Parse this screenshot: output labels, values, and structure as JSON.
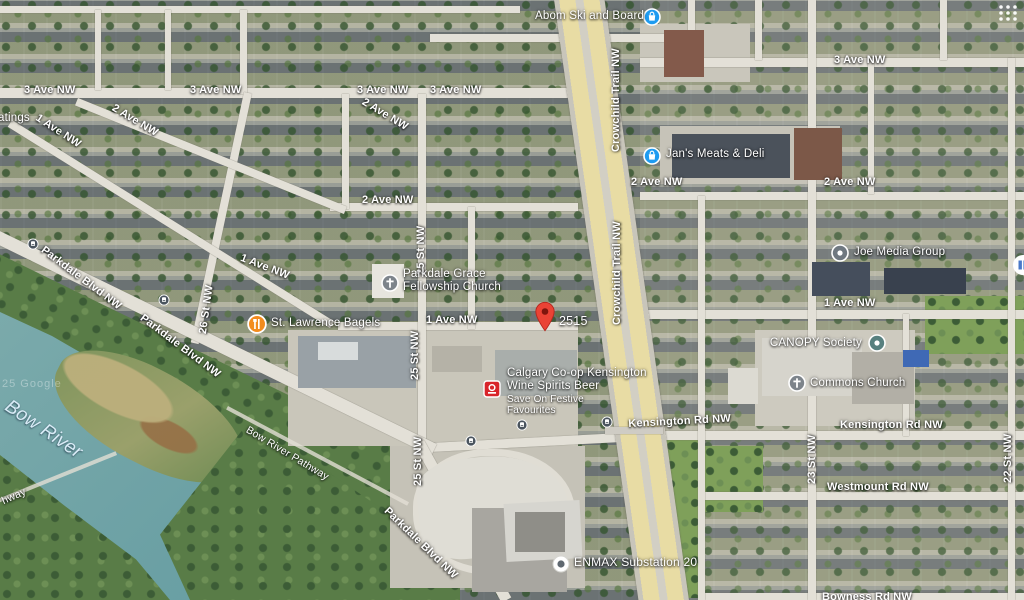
{
  "map": {
    "type": "satellite",
    "watermark": "25 Google",
    "water_name": "Bow River",
    "pathway_label": "Bow River Pathway",
    "pathway_partial": "hway",
    "partial_poi_label": "atings"
  },
  "streets": {
    "ave3": "3 Ave NW",
    "ave2": "2 Ave NW",
    "ave1": "1 Ave NW",
    "crowchild": "Crowchild Trail NW",
    "st25": "25 St NW",
    "st26": "26 St NW",
    "st23": "23 St NW",
    "st22": "22 St NW",
    "kensington": "Kensington Rd NW",
    "westmount": "Westmount Rd NW",
    "bowness": "Bowness Rd NW",
    "parkdale": "Parkdale Blvd NW"
  },
  "pois": {
    "abom": {
      "name": "Abom Ski and Board",
      "icon": "shopping-bag",
      "color": "#1e9bf0"
    },
    "jans": {
      "name": "Jan's Meats & Deli",
      "icon": "shopping-bag",
      "color": "#1e9bf0"
    },
    "joe": {
      "name": "Joe Media Group",
      "icon": "generic-dot",
      "color": "#6f7880"
    },
    "stlawrence": {
      "name": "St. Lawrence Bagels",
      "icon": "restaurant",
      "color": "#f28c1e"
    },
    "parkdale_grace": {
      "line1": "Parkdale Grace",
      "line2": "Fellowship Church",
      "icon": "church",
      "color": "#7d848b"
    },
    "coop": {
      "line1": "Calgary Co-op Kensington",
      "line2": "Wine Spirits Beer",
      "ad_line1": "Save On Festive",
      "ad_line2": "Favourites",
      "icon": "coop-logo",
      "color": "#d8242a"
    },
    "canopy": {
      "name": "CANOPY Society",
      "icon": "generic-dot",
      "color": "#57807f"
    },
    "commons": {
      "name": "Commons Church",
      "icon": "church",
      "color": "#7d848b"
    },
    "enmax": {
      "name": "ENMAX Substation 20",
      "icon": "ring-dot",
      "color": "#5f6870"
    }
  },
  "marker": {
    "label": "2515",
    "color": "#ea4335"
  },
  "transit": {
    "icon": "bus-stop",
    "count": 5
  },
  "ui": {
    "grid_icon": "app-grid",
    "edge_pin_icon": "library-pin"
  },
  "palette": {
    "water": "#6ba0a4",
    "road": "#e3e0d7",
    "highway": "#e8dca4",
    "vegetation": "#597c47"
  }
}
